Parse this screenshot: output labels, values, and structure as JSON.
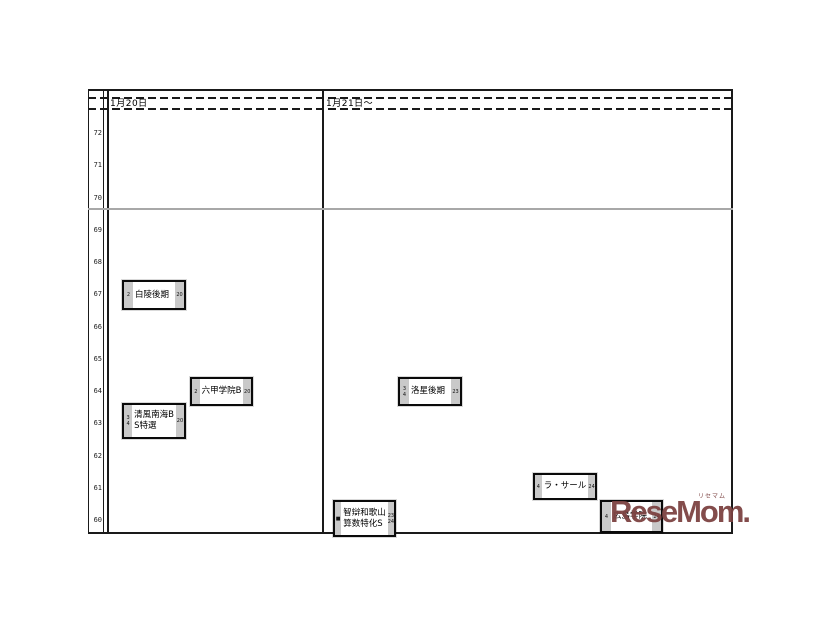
{
  "chart_data": {
    "type": "scatter",
    "title": "中学入試 入試日別 予想偏差値一覧（R4）",
    "xlabel": "入試日",
    "ylabel": "偏差値",
    "ylim": [
      60,
      72
    ],
    "grid": "partial",
    "x_categories": [
      "1月20日",
      "1月21日～"
    ],
    "points": [
      {
        "school": "白陵後期",
        "date_column": "1月20日",
        "value": 67,
        "left_marks": "2",
        "right_marks": "20"
      },
      {
        "school": "六甲学院B",
        "date_column": "1月20日",
        "value": 64,
        "left_marks": "2",
        "right_marks": "20"
      },
      {
        "school": "清風南海B S特選",
        "date_column": "1月20日",
        "value": 63,
        "left_marks": "3・4",
        "right_marks": "20"
      },
      {
        "school": "洛星後期",
        "date_column": "1月21日～",
        "value": 64,
        "left_marks": "3・4",
        "right_marks": "23"
      },
      {
        "school": "ラ・サール",
        "date_column": "1月21日～",
        "value": 61,
        "left_marks": "4",
        "right_marks": "24"
      },
      {
        "school": "智辯和歌山 算数特化S",
        "date_column": "1月21日～",
        "value": 60,
        "left_marks": "■",
        "right_marks": "23・24"
      },
      {
        "school": "広島学院",
        "date_column": "1月21日～",
        "value": 60,
        "left_marks": "4",
        "right_marks": "24"
      }
    ]
  },
  "header": {
    "col1_label": "1月20日",
    "col2_label": "1月21日～"
  },
  "watermark": {
    "logo_text": "ReseMom.",
    "logo_ruby": "リセマム",
    "logo_color": "#7d4342"
  },
  "axis": {
    "x": 102,
    "top": 133,
    "step": 32.25,
    "max": 72,
    "values": [
      "72",
      "71",
      "70",
      "69",
      "68",
      "67",
      "66",
      "65",
      "64",
      "63",
      "62",
      "61",
      "60"
    ]
  },
  "layout": {
    "lines": [
      {
        "x": 88,
        "y": 89,
        "w": 645,
        "h": 2,
        "kind": "solid"
      },
      {
        "x": 88,
        "y": 97,
        "w": 645,
        "h": 2,
        "kind": "dashed"
      },
      {
        "x": 88,
        "y": 108,
        "w": 645,
        "h": 2,
        "kind": "dashed"
      },
      {
        "x": 88,
        "y": 89,
        "w": 1,
        "h": 445,
        "kind": "solid"
      },
      {
        "x": 103,
        "y": 89,
        "w": 1,
        "h": 445,
        "kind": "solid"
      },
      {
        "x": 107,
        "y": 89,
        "w": 2,
        "h": 445,
        "kind": "solid"
      },
      {
        "x": 322,
        "y": 89,
        "w": 2,
        "h": 445,
        "kind": "solid"
      },
      {
        "x": 731,
        "y": 89,
        "w": 2,
        "h": 445,
        "kind": "solid"
      },
      {
        "x": 88,
        "y": 208,
        "w": 645,
        "h": 2,
        "kind": "gray"
      },
      {
        "x": 88,
        "y": 532,
        "w": 645,
        "h": 2,
        "kind": "solid"
      }
    ],
    "boxes": [
      {
        "id": "hakuryo-koki",
        "name_lines": [
          "白陵後期"
        ],
        "left": [
          "2"
        ],
        "right": [
          "20"
        ],
        "x": 122,
        "y": 280,
        "w": 64,
        "h": 30
      },
      {
        "id": "rokko-b",
        "name_lines": [
          "六甲学院B"
        ],
        "left": [
          "2"
        ],
        "right": [
          "20"
        ],
        "x": 190,
        "y": 377,
        "w": 63,
        "h": 29
      },
      {
        "id": "seifu-nankai-b",
        "name_lines": [
          "清風南海B",
          "S特選"
        ],
        "left": [
          "3",
          "4"
        ],
        "right": [
          "20"
        ],
        "x": 122,
        "y": 403,
        "w": 64,
        "h": 36
      },
      {
        "id": "rakusei-koki",
        "name_lines": [
          "洛星後期"
        ],
        "left": [
          "3",
          "4"
        ],
        "right": [
          "23"
        ],
        "x": 398,
        "y": 377,
        "w": 64,
        "h": 29
      },
      {
        "id": "la-salle",
        "name_lines": [
          "ラ・サール"
        ],
        "left": [
          "4"
        ],
        "right": [
          "24"
        ],
        "x": 533,
        "y": 473,
        "w": 64,
        "h": 27
      },
      {
        "id": "chiben-wakayama",
        "name_lines": [
          "智辯和歌山",
          "算数特化S"
        ],
        "left": [
          "■"
        ],
        "right": [
          "23",
          "24"
        ],
        "x": 333,
        "y": 500,
        "w": 63,
        "h": 37
      },
      {
        "id": "hiroshima-gakuin",
        "name_lines": [
          "広島学院"
        ],
        "left": [
          "4"
        ],
        "right": [
          "24"
        ],
        "x": 600,
        "y": 500,
        "w": 63,
        "h": 33
      }
    ]
  }
}
